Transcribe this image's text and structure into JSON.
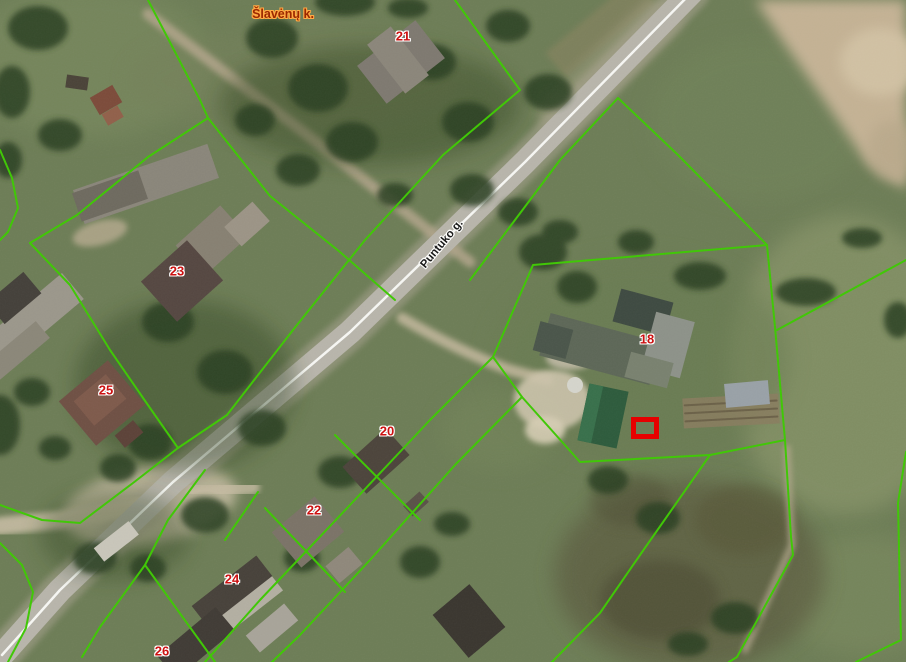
{
  "map": {
    "kind": "aerial-cadastral-map",
    "labels": {
      "village": "Šlavėnų k.",
      "street": "Puntuko g.",
      "parcels": {
        "p21": "21",
        "p23": "23",
        "p25": "25",
        "p20": "20",
        "p22": "22",
        "p24": "24",
        "p26": "26",
        "p18": "18"
      }
    },
    "selection_marker": {
      "shape": "rectangle",
      "color": "#e60000",
      "x": 631,
      "y": 417,
      "width": 28,
      "height": 22
    },
    "colors": {
      "parcel_boundary_line": "#3ec803",
      "house_number_text": "#cc1111",
      "house_number_halo": "#ffffff",
      "street_label_text": "#1a1a1a",
      "village_label_text": "#9c2800",
      "village_label_halo": "#ffaa44",
      "road_centerline": "#f7f7f4",
      "road_surface": "#b8b5ab"
    }
  }
}
